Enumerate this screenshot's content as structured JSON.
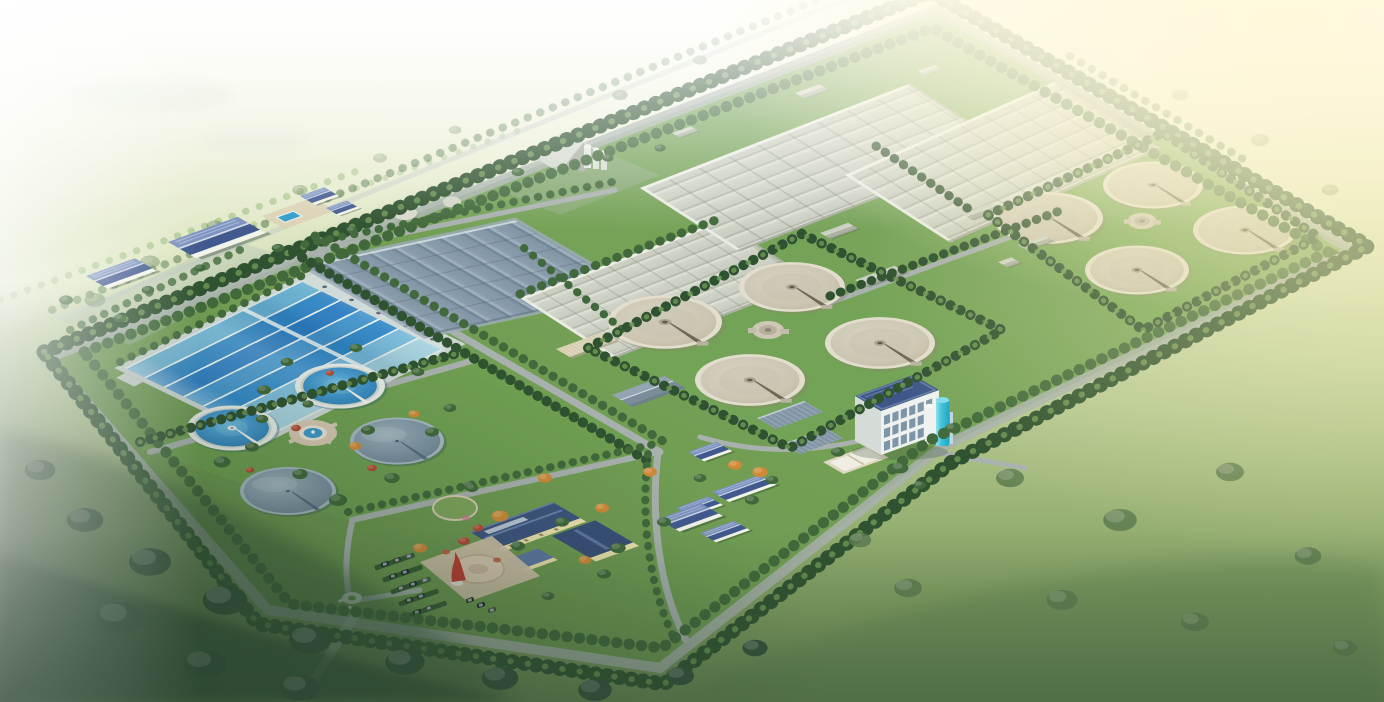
{
  "scene": {
    "alt": "Aerial architectural rendering of a wastewater treatment plant campus: tree-lined perimeter roads around a large parallelogram site, a blue multi-lane sedimentation basin, a slate covered basin, three large ridged aeration basins, two diamond-shaped groups of four beige circular clarifiers with central distribution wells, a landscaped garden with two blue-water clarifiers, two covered round tanks and a fountain plaza, a cream administration building with dark blue roofs, parking with cars, a white blower building with cyan tanks, scattered auxiliary sheds, and hazy green farmland with sun glow at the upper right",
    "type": "architectural-rendering",
    "subject": "wastewater-treatment-plant"
  },
  "palette": {
    "haze_top": "#fbfcf2",
    "field_light": "#dde6c2",
    "field_mid": "#a3ba7e",
    "field_deep": "#6d8c55",
    "forest_dark": "#35523a",
    "forest_band": "#2c4730",
    "field_tree": "#5e7c50",
    "tree_dark": "#2f5230",
    "tree_mid": "#41693b",
    "tree_light": "#79a25a",
    "site_grass": "#6b9750",
    "lawn_light": "#76a657",
    "road": "#a9b1ae",
    "road_light": "#c3cbc6",
    "aeration_roof": "#d0d4c8",
    "aeration_ridge": "#b0b5a7",
    "slate_roof": "#8b9dac",
    "slate_ridge": "#6e8292",
    "water_deep": "#2b7ab2",
    "water_mid": "#4397cc",
    "water_light": "#6cb9e0",
    "lane_divider": "#e6efed",
    "clarifier_fill": "#cbc5b2",
    "clarifier_rim": "#e2ddcd",
    "clarifier_arm": "#6e6957",
    "covered_tank": "#8095a5",
    "admin_roof": "#3d5480",
    "admin_wall": "#efe5b0",
    "cottage_roof": "#41598f",
    "white_wall": "#f2f3ea",
    "shed_roof": "#ccd0c4",
    "blower_wall": "#eef1ee",
    "blower_window": "#7d95a8",
    "cyan_tank": "#3fc3dc",
    "plaza_paving": "#d6c3ac",
    "sculpture_red": "#c23a30",
    "fountain_water": "#3e98cc",
    "sun_glow": "#fff9da"
  },
  "site": {
    "features": [
      {
        "name": "perimeter-tree-lined-road"
      },
      {
        "name": "blue-lane-sedimentation-basin",
        "lanes": 7
      },
      {
        "name": "covered-slate-basin"
      },
      {
        "name": "aeration-basins",
        "count": 3
      },
      {
        "name": "central-clarifier-group",
        "tanks": 4
      },
      {
        "name": "east-clarifier-group",
        "tanks": 4
      },
      {
        "name": "garden-clarifiers-blue-water",
        "tanks": 2
      },
      {
        "name": "garden-clarifiers-covered",
        "tanks": 2
      },
      {
        "name": "fountain-plaza"
      },
      {
        "name": "administration-building"
      },
      {
        "name": "parking-lot",
        "cars": 15
      },
      {
        "name": "blower-building-with-cyan-tanks"
      },
      {
        "name": "pump-station-with-silos"
      },
      {
        "name": "auxiliary-sheds",
        "count": 12
      },
      {
        "name": "gatehouse-roundabout"
      }
    ]
  }
}
